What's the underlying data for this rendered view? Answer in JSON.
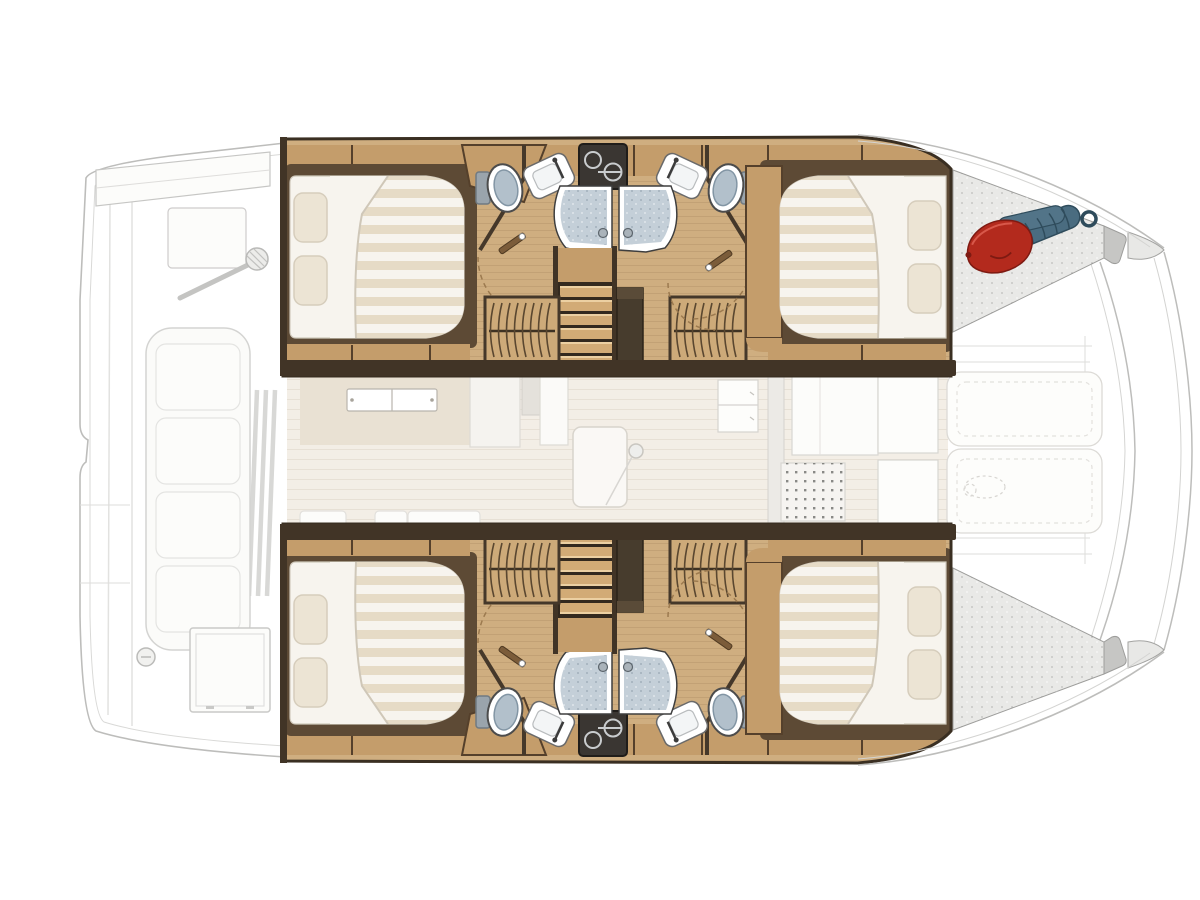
{
  "boat": {
    "type": "catamaran",
    "view": "Catamaran interior layout floor plan, top-down view",
    "hulls": [
      {
        "name": "port hull (top)",
        "highlighted": true,
        "rooms": [
          {
            "name": "forward double cabin",
            "fixtures": [
              "double bed",
              "striped duvet",
              "2 pillows"
            ]
          },
          {
            "name": "forward head",
            "fixtures": [
              "toilet",
              "washbasin",
              "dark vanity with round sink",
              "shower stall"
            ]
          },
          {
            "name": "companionway",
            "fixtures": [
              "stairs",
              "landing"
            ]
          },
          {
            "name": "hanging wardrobes",
            "count": 2
          },
          {
            "name": "aft head",
            "fixtures": [
              "toilet",
              "washbasin",
              "shower stall"
            ]
          },
          {
            "name": "aft double cabin",
            "fixtures": [
              "double bed",
              "striped duvet",
              "2 pillows"
            ]
          }
        ],
        "transom_platform_items": [
          "red fender",
          "blue coiled mooring line"
        ]
      },
      {
        "name": "starboard hull (bottom)",
        "highlighted": true,
        "mirror_of": "port hull (top)",
        "transom_platform_items": []
      }
    ],
    "center_deck": {
      "name": "salon, galley and cockpit (faded)",
      "features": [
        "galley counter with double sink",
        "cabinet blocks",
        "door with knob",
        "drawer unit",
        "round galley sink",
        "deck grate mat",
        "cockpit bench cushions"
      ]
    },
    "bow_deck": {
      "name": "foredeck (faded)",
      "features": [
        "forward crossbeam",
        "anchor roller arm",
        "forward seating cushions",
        "trampoline slats",
        "deck hatch",
        "windlass"
      ]
    },
    "counts": {
      "double_beds": 4,
      "toilets": 4,
      "washbasins": 4,
      "shower_stalls": 4,
      "wardrobes": 4,
      "stair_flights": 2
    }
  },
  "colors": {
    "wood_floor": "#cfae80",
    "wood_cabinet": "#c49d6b",
    "wood_cabinet_light": "#dcc094",
    "wood_dark": "#5d4a35",
    "wood_wall": "#413426",
    "stair_tread": "#d2ab76",
    "void_dark": "#473c2d",
    "vanity_dark": "#3a3632",
    "shower_floor": "#c4cfd8",
    "toilet_lid": "#b2c0cb",
    "bed_sheet": "#f7f4ee",
    "bed_stripe": "#e6dbc6",
    "pillow": "#ece4d4",
    "salon_floor": "#f3eee6",
    "salon_counter": "#e9e1d3",
    "faded_stroke": "#bdbdbb",
    "faded_fill": "#fcfcfa",
    "platform": "#e9e9e7",
    "platform_edge": "#c6c6c4",
    "fender_red": "#b32a1d",
    "fender_dark": "#7e1a12",
    "rope_teal": "#4a6c80",
    "rope_dark": "#2f4c5c"
  }
}
